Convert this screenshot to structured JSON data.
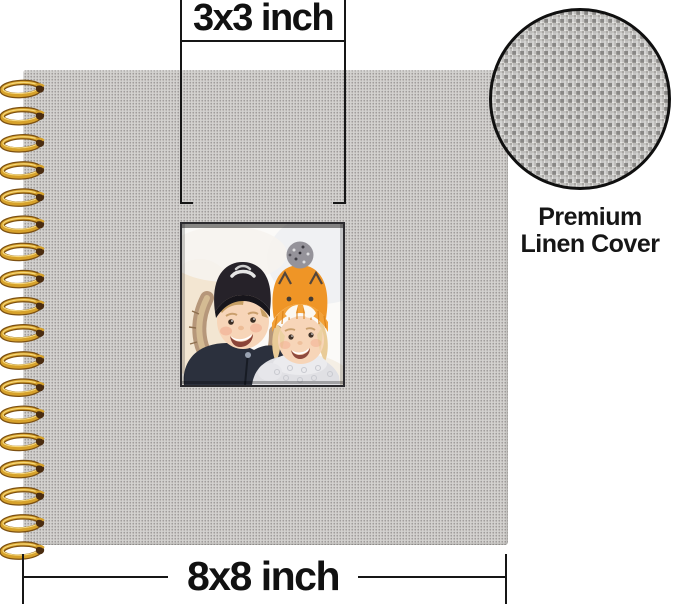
{
  "annotations": {
    "top_dimension": {
      "label": "3x3 inch"
    },
    "bottom_dimension": {
      "label": "8x8 inch"
    },
    "callout": {
      "line1": "Premium",
      "line2": "Linen Cover"
    },
    "line_color": "#161616"
  },
  "album": {
    "cover_color": "#ccc9c5",
    "window_photo": {
      "description": "Two smiling children outdoors in winter hats",
      "colors": {
        "boy_hat": "#262229",
        "boy_coat": "#2b303d",
        "fur_trim": "#b6977a",
        "girl_hat": "#ef9526",
        "girl_hat_brim": "#f3a239",
        "girl_jacket": "#e0e0e4",
        "pompom": "#95939a",
        "skin": "#f7d5b8"
      }
    },
    "spiral": {
      "loop_count": 18,
      "first_y": 89,
      "spacing": 27.15,
      "gold_dark": "#7c5012",
      "gold_mid": "#d7a22b",
      "gold_light": "#f6d87c",
      "hole_color": "#4a2c10"
    }
  }
}
